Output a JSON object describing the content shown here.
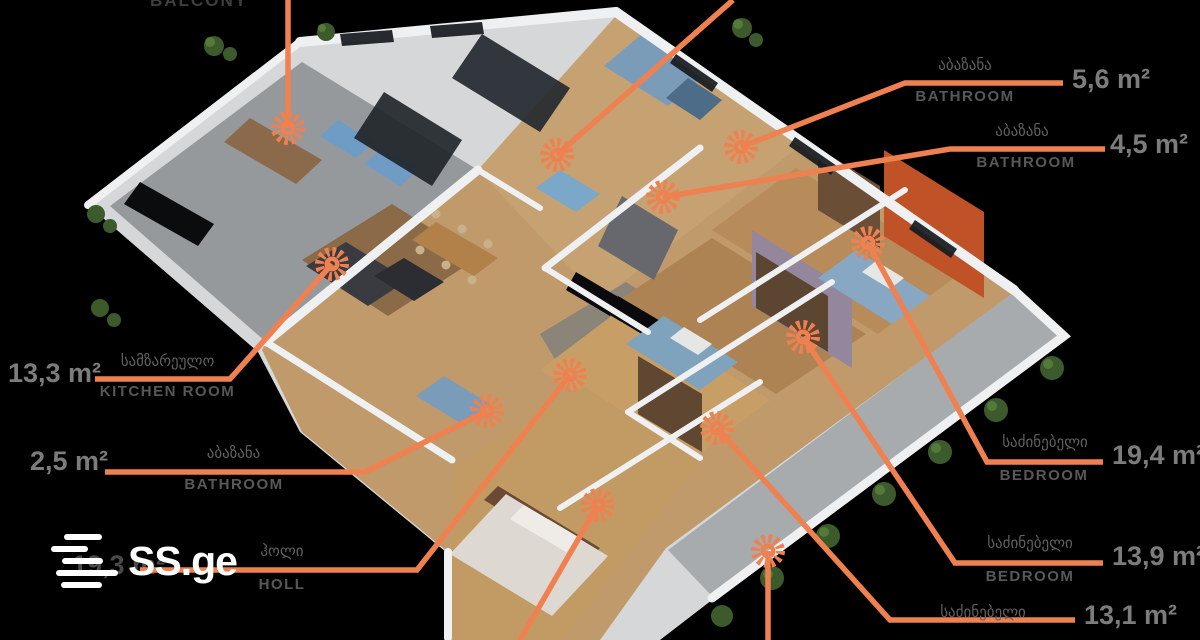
{
  "page": {
    "background": "#000000"
  },
  "watermark": {
    "logo_text": "SS.ge"
  },
  "icons": {
    "room_marker": "orange-sunburst",
    "logo_mark": "stacked-rounded-bars"
  },
  "colors": {
    "accent_orange": "#EF8150",
    "georgian_label": "#616161",
    "english_label": "#585858",
    "area_value": "#7c7c7c",
    "balcony_label": "#3e3e3e",
    "hall_value_dimmed": "#4a4a4a"
  },
  "rooms": {
    "balcony": {
      "name_en": "BALCONY"
    },
    "bathroom_56": {
      "name_ka": "აბაზანა",
      "name_en": "BATHROOM",
      "area": "5,6 m²"
    },
    "bathroom_45": {
      "name_ka": "აბაზანა",
      "name_en": "BATHROOM",
      "area": "4,5 m²"
    },
    "kitchen": {
      "name_ka": "სამზარეულო",
      "name_en": "KITCHEN ROOM",
      "area": "13,3 m²"
    },
    "bathroom_25": {
      "name_ka": "აბაზანა",
      "name_en": "BATHROOM",
      "area": "2,5 m²"
    },
    "hall": {
      "name_ka": "ჰოლი",
      "name_en": "HOLL",
      "area": "19,3 m²"
    },
    "bedroom_194": {
      "name_ka": "საძინებელი",
      "name_en": "BEDROOM",
      "area": "19,4 m²"
    },
    "bedroom_139": {
      "name_ka": "საძინებელი",
      "name_en": "BEDROOM",
      "area": "13,9 m²"
    },
    "bedroom_131": {
      "name_ka": "საძინებელი",
      "area": "13,1 m²"
    }
  }
}
